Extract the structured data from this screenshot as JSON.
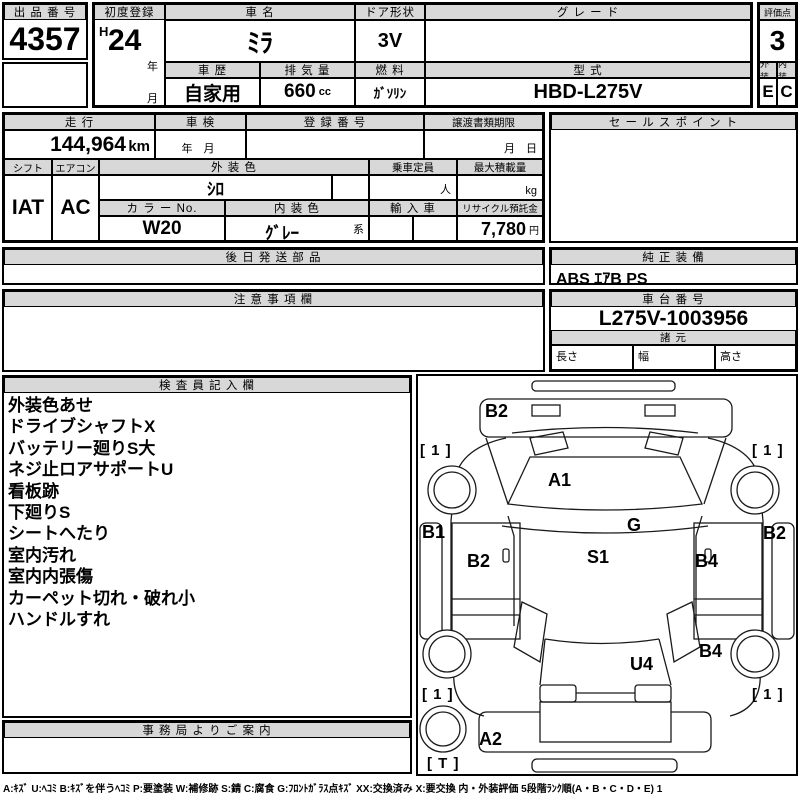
{
  "colors": {
    "header_bg": "#d8d8d8",
    "border": "#000000",
    "text": "#000000"
  },
  "top": {
    "auction_no": {
      "label": "出 品 番 号",
      "value": "4357"
    },
    "first_reg": {
      "label": "初度登録",
      "era": "H",
      "year": "24",
      "year_unit": "年",
      "month_unit": "月"
    },
    "car_name": {
      "label": "車 名",
      "value": "ﾐﾗ"
    },
    "door": {
      "label": "ドア形状",
      "value": "3V"
    },
    "grade": {
      "label": "グ レ ー ド",
      "value": ""
    },
    "history": {
      "label": "車 歴",
      "value": "自家用"
    },
    "displacement": {
      "label": "排 気 量",
      "value": "660",
      "unit": "cc"
    },
    "fuel": {
      "label": "燃 料",
      "value": "ｶﾞｿﾘﾝ"
    },
    "model": {
      "label": "型 式",
      "value": "HBD-L275V"
    },
    "score": {
      "label": "評価点",
      "value": "3"
    },
    "exterior": {
      "label": "外装",
      "value": "E"
    },
    "interior": {
      "label": "内装",
      "value": "C"
    }
  },
  "info": {
    "mileage": {
      "label": "走 行",
      "value": "144,964",
      "unit": "km"
    },
    "shaken": {
      "label": "車 検",
      "placeholder": "年　月"
    },
    "reg_no": {
      "label": "登 録 番 号",
      "value": ""
    },
    "transfer_docs": {
      "label": "譲渡書類期限",
      "placeholder": "月　日"
    },
    "sales_point": {
      "label": "セ ー ル ス ポ イ ン ト",
      "value": ""
    },
    "shift": {
      "label": "シフト",
      "value": "IAT"
    },
    "aircon": {
      "label": "エアコン",
      "value": "AC"
    },
    "ext_color": {
      "label": "外 装 色",
      "value": "ｼﾛ"
    },
    "capacity": {
      "label": "乗車定員",
      "unit": "人"
    },
    "max_load": {
      "label": "最大積載量",
      "unit": "kg"
    },
    "color_no": {
      "label": "カ ラ ー No.",
      "value": "W20"
    },
    "int_color": {
      "label": "内 装 色",
      "value": "ｸﾞﾚｰ",
      "suffix": "系"
    },
    "import_car": {
      "label": "輸 入 車",
      "value": ""
    },
    "recycle": {
      "label": "リサイクル預託金",
      "value": "7,780",
      "unit": "円"
    }
  },
  "mid": {
    "later_parts": {
      "label": "後 日 発 送 部 品",
      "value": ""
    },
    "oem_equipment": {
      "label": "純 正 装 備",
      "value": "ABS ｴｱB PS"
    },
    "cautions": {
      "label": "注 意 事 項 欄",
      "value": ""
    },
    "chassis_no": {
      "label": "車 台 番 号",
      "value": "L275V-1003956"
    },
    "specs": {
      "label": "諸 元",
      "length_label": "長さ",
      "width_label": "幅",
      "height_label": "高さ"
    }
  },
  "inspector": {
    "label": "検 査 員 記 入 欄",
    "items": [
      "外装色あせ",
      "ドライブシャフトX",
      "バッテリー廻りS大",
      "ネジ止ロアサポートU",
      "看板跡",
      "下廻りS",
      "シートへたり",
      "室内汚れ",
      "室内内張傷",
      "カーペット切れ・破れ小",
      "ハンドルすれ"
    ]
  },
  "office_notice": {
    "label": "事 務 局 よ り ご 案 内",
    "value": ""
  },
  "diagram": {
    "marks": [
      {
        "text": "B2",
        "x": 67,
        "y": 41,
        "kind": "code"
      },
      {
        "text": "[ 1 ]",
        "x": 2,
        "y": 79,
        "kind": "corner"
      },
      {
        "text": "[ 1 ]",
        "x": 334,
        "y": 79,
        "kind": "corner"
      },
      {
        "text": "A1",
        "x": 130,
        "y": 110,
        "kind": "code"
      },
      {
        "text": "B1",
        "x": 4,
        "y": 162,
        "kind": "code"
      },
      {
        "text": "G",
        "x": 209,
        "y": 155,
        "kind": "code"
      },
      {
        "text": "B2",
        "x": 49,
        "y": 191,
        "kind": "code"
      },
      {
        "text": "S1",
        "x": 169,
        "y": 187,
        "kind": "code"
      },
      {
        "text": "B4",
        "x": 277,
        "y": 191,
        "kind": "code"
      },
      {
        "text": "B2",
        "x": 345,
        "y": 163,
        "kind": "code"
      },
      {
        "text": "B4",
        "x": 281,
        "y": 281,
        "kind": "code"
      },
      {
        "text": "U4",
        "x": 212,
        "y": 294,
        "kind": "code"
      },
      {
        "text": "[ 1 ]",
        "x": 4,
        "y": 323,
        "kind": "corner"
      },
      {
        "text": "[ 1 ]",
        "x": 334,
        "y": 323,
        "kind": "corner"
      },
      {
        "text": "A2",
        "x": 61,
        "y": 369,
        "kind": "code"
      },
      {
        "text": "[ T ]",
        "x": 9,
        "y": 392,
        "kind": "corner"
      }
    ]
  },
  "legend": "A:ｷｽﾞ U:ﾍｺﾐ B:ｷｽﾞを伴うﾍｺﾐ P:要塗装 W:補修跡 S:錆 C:腐食 G:ﾌﾛﾝﾄｶﾞﾗｽ点ｷｽﾞ XX:交換済み X:要交換  内・外装評価  5段階ﾗﾝｸ順(A・B・C・D・E) 1"
}
